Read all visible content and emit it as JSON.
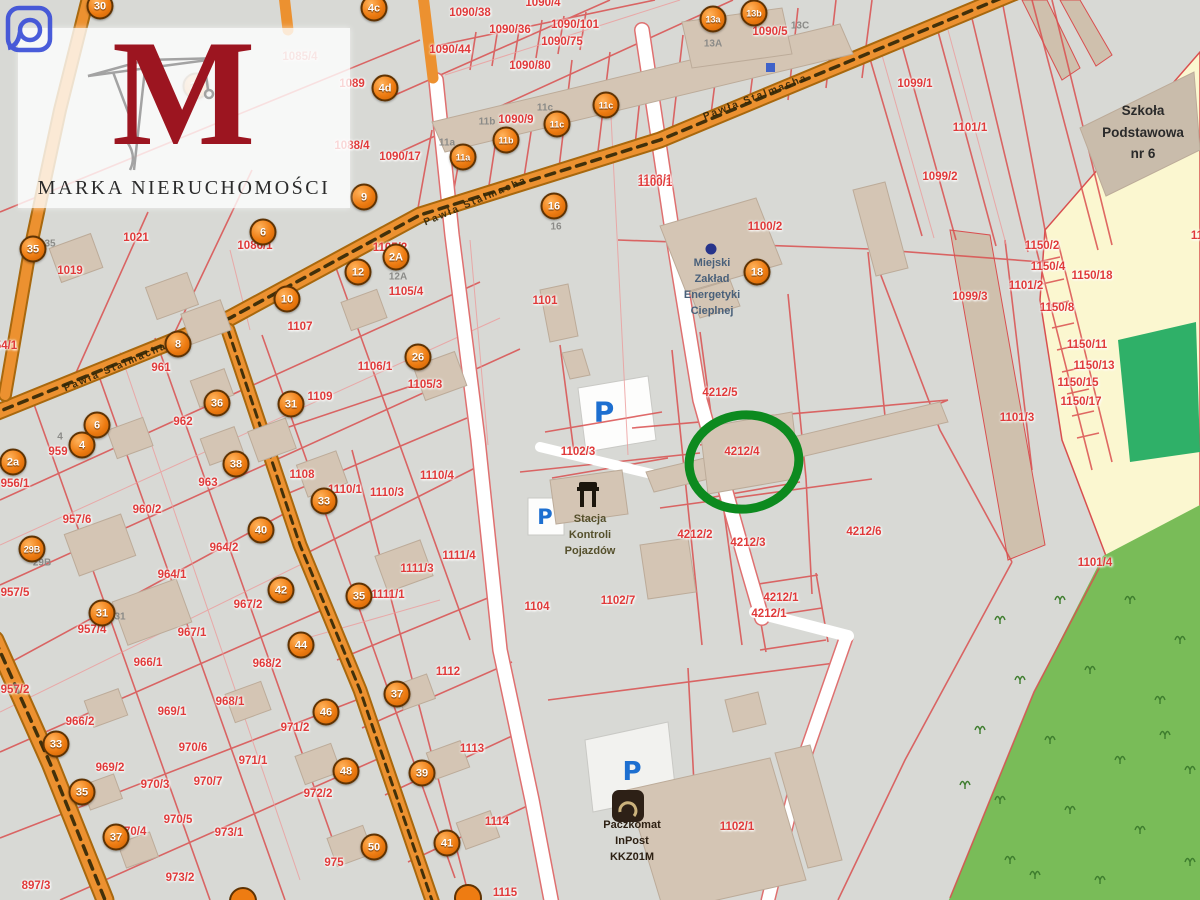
{
  "watermark": {
    "logo_letter": "M",
    "brand": "MARKA NIERUCHOMOŚCI"
  },
  "streets": {
    "main": "Pawła Stalmacha"
  },
  "pois": {
    "school": {
      "label": "Szkoła\nPodstawowa\nnr 6"
    },
    "mzec": {
      "label": "Miejski\nZakład\nEnergetyki\nCieplnej"
    },
    "stacja": {
      "label": "Stacja\nKontroli\nPojazdów"
    },
    "paczkomat": {
      "label": "Paczkomat\nInPost\nKKZ01M"
    },
    "parking_letter": "P"
  },
  "highlight": {
    "parcel": "4212/4",
    "color": "#0d8a1f"
  },
  "colors": {
    "map_bg": "#d8d9d5",
    "parcel_line": "#d94f4f",
    "road_orange": "#ec9130",
    "school_yellow": "#fbf7d0",
    "forest_green": "#79bc58",
    "field_green": "#2fb068",
    "building_tan": "#d4c5b4",
    "marker_orange": "#ee7c12",
    "label_red": "#e03a3a",
    "parking_blue": "#1d6fd0",
    "highlight_green": "#0d8a1f"
  },
  "markers": [
    {
      "t": "30",
      "x": 100,
      "y": 6
    },
    {
      "t": "27",
      "x": 196,
      "y": 86,
      "o": 0.5
    },
    {
      "t": "4c",
      "x": 374,
      "y": 8
    },
    {
      "t": "4d",
      "x": 385,
      "y": 88
    },
    {
      "t": "9",
      "x": 364,
      "y": 197
    },
    {
      "t": "6",
      "x": 263,
      "y": 232
    },
    {
      "t": "12",
      "x": 358,
      "y": 272
    },
    {
      "t": "2A",
      "x": 396,
      "y": 257
    },
    {
      "t": "10",
      "x": 287,
      "y": 299
    },
    {
      "t": "31",
      "x": 291,
      "y": 404
    },
    {
      "t": "26",
      "x": 418,
      "y": 357
    },
    {
      "t": "16",
      "x": 554,
      "y": 206
    },
    {
      "t": "18",
      "x": 757,
      "y": 272
    },
    {
      "t": "13a",
      "x": 713,
      "y": 19
    },
    {
      "t": "13b",
      "x": 754,
      "y": 13
    },
    {
      "t": "11a",
      "x": 463,
      "y": 157
    },
    {
      "t": "11b",
      "x": 506,
      "y": 140
    },
    {
      "t": "11c",
      "x": 557,
      "y": 124
    },
    {
      "t": "11c",
      "x": 606,
      "y": 105
    },
    {
      "t": "35",
      "x": 33,
      "y": 249
    },
    {
      "t": "8",
      "x": 178,
      "y": 344
    },
    {
      "t": "36",
      "x": 217,
      "y": 403
    },
    {
      "t": "6",
      "x": 97,
      "y": 425
    },
    {
      "t": "4",
      "x": 82,
      "y": 445
    },
    {
      "t": "2a",
      "x": 13,
      "y": 462
    },
    {
      "t": "38",
      "x": 236,
      "y": 464
    },
    {
      "t": "40",
      "x": 261,
      "y": 530
    },
    {
      "t": "29B",
      "x": 32,
      "y": 549
    },
    {
      "t": "31",
      "x": 102,
      "y": 613
    },
    {
      "t": "42",
      "x": 281,
      "y": 590
    },
    {
      "t": "33",
      "x": 324,
      "y": 501
    },
    {
      "t": "35",
      "x": 359,
      "y": 596
    },
    {
      "t": "44",
      "x": 301,
      "y": 645
    },
    {
      "t": "33",
      "x": 56,
      "y": 744
    },
    {
      "t": "46",
      "x": 326,
      "y": 712
    },
    {
      "t": "35",
      "x": 82,
      "y": 792
    },
    {
      "t": "48",
      "x": 346,
      "y": 771
    },
    {
      "t": "39",
      "x": 422,
      "y": 773
    },
    {
      "t": "37",
      "x": 116,
      "y": 837
    },
    {
      "t": "50",
      "x": 374,
      "y": 847
    },
    {
      "t": "41",
      "x": 447,
      "y": 843
    },
    {
      "t": "37",
      "x": 397,
      "y": 694
    }
  ],
  "parcel_labels": [
    {
      "t": "1021",
      "x": 136,
      "y": 238
    },
    {
      "t": "1019",
      "x": 70,
      "y": 271
    },
    {
      "t": "961",
      "x": 161,
      "y": 368
    },
    {
      "t": "962",
      "x": 183,
      "y": 422
    },
    {
      "t": "963",
      "x": 208,
      "y": 483
    },
    {
      "t": "956/1",
      "x": 15,
      "y": 484
    },
    {
      "t": "959",
      "x": 58,
      "y": 452
    },
    {
      "t": "957/6",
      "x": 77,
      "y": 520
    },
    {
      "t": "960/2",
      "x": 147,
      "y": 510
    },
    {
      "t": "964/2",
      "x": 224,
      "y": 548
    },
    {
      "t": "964/1",
      "x": 172,
      "y": 575
    },
    {
      "t": "957/5",
      "x": 15,
      "y": 593
    },
    {
      "t": "957/4",
      "x": 92,
      "y": 630
    },
    {
      "t": "967/1",
      "x": 192,
      "y": 633
    },
    {
      "t": "966/1",
      "x": 148,
      "y": 663
    },
    {
      "t": "957/2",
      "x": 15,
      "y": 690
    },
    {
      "t": "966/2",
      "x": 80,
      "y": 722
    },
    {
      "t": "968/1",
      "x": 230,
      "y": 702
    },
    {
      "t": "969/1",
      "x": 172,
      "y": 712
    },
    {
      "t": "970/6",
      "x": 193,
      "y": 748
    },
    {
      "t": "969/2",
      "x": 110,
      "y": 768
    },
    {
      "t": "970/3",
      "x": 155,
      "y": 785
    },
    {
      "t": "970/7",
      "x": 208,
      "y": 782
    },
    {
      "t": "970/5",
      "x": 178,
      "y": 820
    },
    {
      "t": "970/4",
      "x": 132,
      "y": 832
    },
    {
      "t": "973/1",
      "x": 229,
      "y": 833
    },
    {
      "t": "973/2",
      "x": 180,
      "y": 878
    },
    {
      "t": "897/3",
      "x": 36,
      "y": 886
    },
    {
      "t": "54/1",
      "x": 6,
      "y": 346
    },
    {
      "t": "1086/1",
      "x": 255,
      "y": 246
    },
    {
      "t": "1107",
      "x": 300,
      "y": 327
    },
    {
      "t": "1109",
      "x": 320,
      "y": 397
    },
    {
      "t": "1105/4",
      "x": 406,
      "y": 292
    },
    {
      "t": "1105/2",
      "x": 390,
      "y": 248
    },
    {
      "t": "1105/3",
      "x": 425,
      "y": 385
    },
    {
      "t": "1106/1",
      "x": 375,
      "y": 367
    },
    {
      "t": "1108",
      "x": 302,
      "y": 475
    },
    {
      "t": "1110/1",
      "x": 345,
      "y": 490
    },
    {
      "t": "1110/3",
      "x": 387,
      "y": 493
    },
    {
      "t": "1110/4",
      "x": 437,
      "y": 476
    },
    {
      "t": "1111/4",
      "x": 459,
      "y": 556
    },
    {
      "t": "1111/3",
      "x": 417,
      "y": 569
    },
    {
      "t": "1111/1",
      "x": 388,
      "y": 595
    },
    {
      "t": "967/2",
      "x": 248,
      "y": 605
    },
    {
      "t": "968/2",
      "x": 267,
      "y": 664
    },
    {
      "t": "971/2",
      "x": 295,
      "y": 728
    },
    {
      "t": "971/1",
      "x": 253,
      "y": 761
    },
    {
      "t": "972/2",
      "x": 318,
      "y": 794
    },
    {
      "t": "975",
      "x": 334,
      "y": 863
    },
    {
      "t": "1112",
      "x": 448,
      "y": 672
    },
    {
      "t": "1113",
      "x": 472,
      "y": 749
    },
    {
      "t": "1114",
      "x": 497,
      "y": 822
    },
    {
      "t": "1115",
      "x": 505,
      "y": 893
    },
    {
      "t": "1090/38",
      "x": 470,
      "y": 13
    },
    {
      "t": "1090/36",
      "x": 510,
      "y": 30
    },
    {
      "t": "1090/101",
      "x": 575,
      "y": 25
    },
    {
      "t": "1090/4",
      "x": 543,
      "y": 3
    },
    {
      "t": "1090/75",
      "x": 562,
      "y": 42
    },
    {
      "t": "1090/80",
      "x": 530,
      "y": 66
    },
    {
      "t": "1090/44",
      "x": 450,
      "y": 50
    },
    {
      "t": "1090/17",
      "x": 400,
      "y": 157
    },
    {
      "t": "1090/5",
      "x": 770,
      "y": 32
    },
    {
      "t": "1090/9",
      "x": 516,
      "y": 120
    },
    {
      "t": "1103/1",
      "x": 655,
      "y": 180
    },
    {
      "t": "1099/1",
      "x": 915,
      "y": 84
    },
    {
      "t": "1101/1",
      "x": 970,
      "y": 128
    },
    {
      "t": "1099/2",
      "x": 940,
      "y": 177
    },
    {
      "t": "1100/1",
      "x": 655,
      "y": 183
    },
    {
      "t": "1100/2",
      "x": 765,
      "y": 227
    },
    {
      "t": "1101",
      "x": 545,
      "y": 301
    },
    {
      "t": "1099/3",
      "x": 970,
      "y": 297
    },
    {
      "t": "1150/2",
      "x": 1042,
      "y": 246
    },
    {
      "t": "1150/4",
      "x": 1048,
      "y": 267
    },
    {
      "t": "1150/18",
      "x": 1092,
      "y": 276
    },
    {
      "t": "1101/2",
      "x": 1026,
      "y": 286
    },
    {
      "t": "1150/8",
      "x": 1057,
      "y": 308
    },
    {
      "t": "1150/11",
      "x": 1087,
      "y": 345
    },
    {
      "t": "1150/13",
      "x": 1094,
      "y": 366
    },
    {
      "t": "1150/15",
      "x": 1078,
      "y": 383
    },
    {
      "t": "1150/17",
      "x": 1081,
      "y": 402
    },
    {
      "t": "1101/3",
      "x": 1017,
      "y": 418
    },
    {
      "t": "1101/4",
      "x": 1095,
      "y": 563
    },
    {
      "t": "11",
      "x": 1197,
      "y": 236
    },
    {
      "t": "4212/5",
      "x": 720,
      "y": 393
    },
    {
      "t": "4212/4",
      "x": 742,
      "y": 452
    },
    {
      "t": "1102/3",
      "x": 578,
      "y": 452
    },
    {
      "t": "4212/2",
      "x": 695,
      "y": 535
    },
    {
      "t": "4212/3",
      "x": 748,
      "y": 543
    },
    {
      "t": "4212/6",
      "x": 864,
      "y": 532
    },
    {
      "t": "1102/7",
      "x": 618,
      "y": 601
    },
    {
      "t": "1104",
      "x": 537,
      "y": 607
    },
    {
      "t": "4212/1",
      "x": 781,
      "y": 598
    },
    {
      "t": "4212/1",
      "x": 769,
      "y": 614
    },
    {
      "t": "1102/1",
      "x": 737,
      "y": 827
    },
    {
      "t": "1089",
      "x": 352,
      "y": 84
    },
    {
      "t": "1088/4",
      "x": 352,
      "y": 146
    },
    {
      "t": "1085/4",
      "x": 300,
      "y": 57,
      "o": 0.55
    }
  ],
  "building_labels": [
    {
      "t": "13A",
      "x": 713,
      "y": 44
    },
    {
      "t": "13C",
      "x": 800,
      "y": 26
    },
    {
      "t": "11a",
      "x": 447,
      "y": 143
    },
    {
      "t": "11b",
      "x": 487,
      "y": 122
    },
    {
      "t": "11c",
      "x": 545,
      "y": 108
    },
    {
      "t": "16",
      "x": 556,
      "y": 227
    },
    {
      "t": "12A",
      "x": 398,
      "y": 277
    },
    {
      "t": "35",
      "x": 50,
      "y": 244
    },
    {
      "t": "4",
      "x": 60,
      "y": 437
    },
    {
      "t": "29B",
      "x": 42,
      "y": 563
    },
    {
      "t": "31",
      "x": 120,
      "y": 617
    }
  ],
  "parking": [
    {
      "x": 604,
      "y": 412,
      "s": 28
    },
    {
      "x": 545,
      "y": 517,
      "s": 21
    },
    {
      "x": 632,
      "y": 772,
      "s": 26
    }
  ]
}
